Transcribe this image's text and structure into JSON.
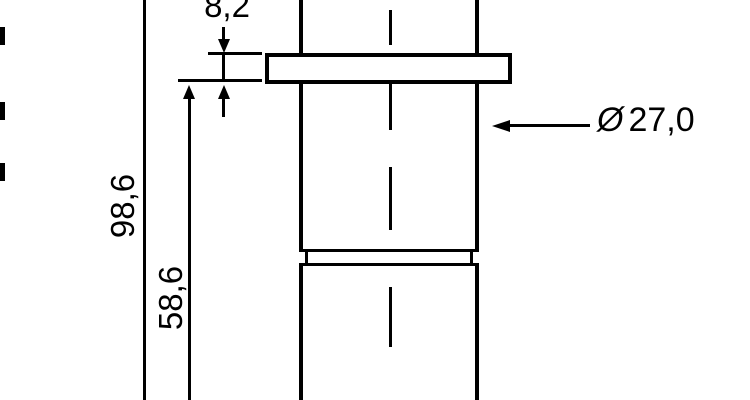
{
  "dimensions": {
    "flange_thickness": "8,2",
    "overall_length": "98,6",
    "body_length": "58,6",
    "diameter_symbol": "Ø",
    "diameter_value": "27,0"
  },
  "colors": {
    "line": "#000000",
    "background": "#ffffff"
  }
}
